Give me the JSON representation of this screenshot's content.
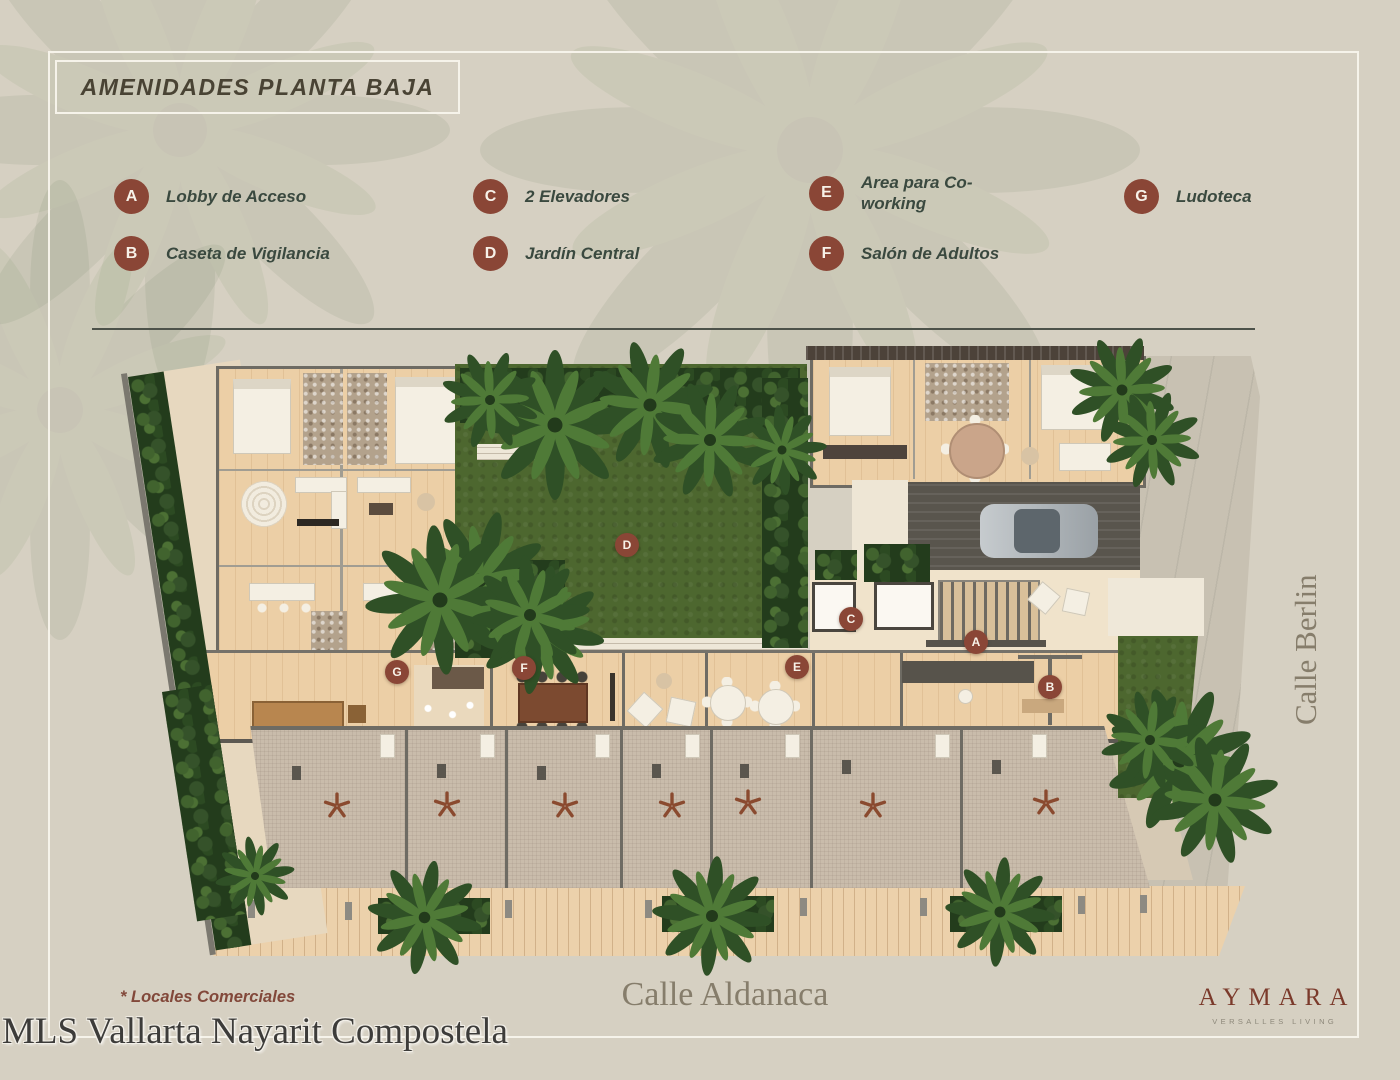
{
  "header": {
    "title": "AMENIDADES PLANTA BAJA"
  },
  "legend": {
    "items": [
      {
        "letter": "A",
        "label": "Lobby de Acceso"
      },
      {
        "letter": "B",
        "label": "Caseta de Vigilancia"
      },
      {
        "letter": "C",
        "label": "2 Elevadores"
      },
      {
        "letter": "D",
        "label": "Jardín Central"
      },
      {
        "letter": "E",
        "label": "Area para Co-working"
      },
      {
        "letter": "F",
        "label": "Salón de Adultos"
      },
      {
        "letter": "G",
        "label": "Ludoteca"
      }
    ],
    "marker_color": "#8a4636",
    "text_color": "#3a493f"
  },
  "streets": {
    "right": "Calle Berlin",
    "bottom": "Calle Aldanaca"
  },
  "footer": {
    "note": "* Locales Comerciales",
    "brand": "AYMARA",
    "brand_sub": "VERSALLES LIVING"
  },
  "watermark": {
    "text": "MLS Vallarta Nayarit Compostela"
  },
  "colors": {
    "background": "#d6d0c2",
    "frame": "#f6f3ea",
    "lawn": "#4d672f",
    "wood_floor": "#eccfa6",
    "commercial_tile": "#c9bcab",
    "star": "#8a4a2f"
  }
}
